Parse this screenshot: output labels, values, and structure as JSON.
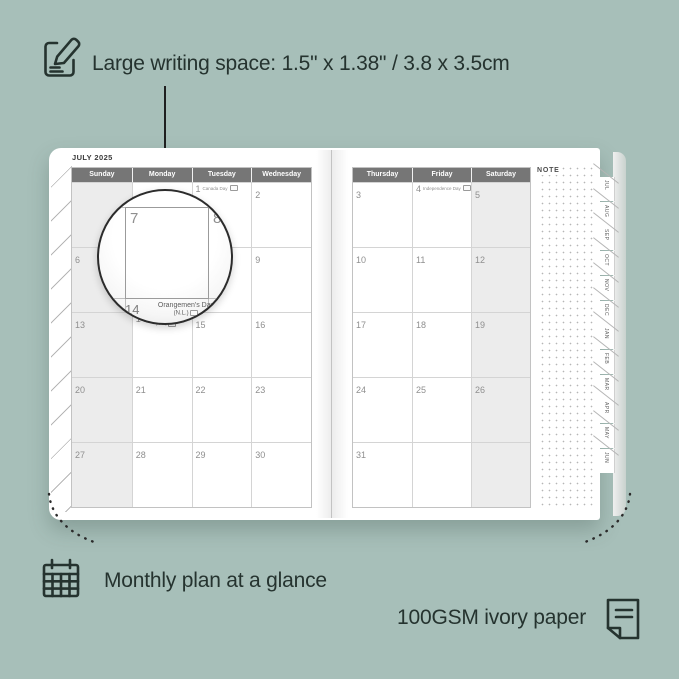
{
  "colors": {
    "background": "#a7bfb9",
    "ink": "#25332f",
    "header_bar": "#767676",
    "shaded_cell": "#ececec",
    "page": "#ffffff"
  },
  "annotations": {
    "top": {
      "icon": "note-pencil-icon",
      "text": "Large writing space: 1.5\" x 1.38\" / 3.8 x 3.5cm"
    },
    "bottom_left": {
      "icon": "calendar-icon",
      "text": "Monthly plan at a glance"
    },
    "bottom_right": {
      "icon": "paper-icon",
      "text": "100GSM ivory paper"
    }
  },
  "planner": {
    "month_title": "JULY 2025",
    "note_label": "NOTE",
    "left_page": {
      "day_headers": [
        "Sunday",
        "Monday",
        "Tuesday",
        "Wednesday"
      ],
      "rows": [
        [
          {
            "d": ""
          },
          {
            "d": ""
          },
          {
            "d": "1",
            "h": "Canada Day"
          },
          {
            "d": "2"
          }
        ],
        [
          {
            "d": "6"
          },
          {
            "d": "7"
          },
          {
            "d": "8"
          },
          {
            "d": "9"
          }
        ],
        [
          {
            "d": "13"
          },
          {
            "d": "14",
            "h": "Orangemen's Day",
            "h2": "(N.L.)"
          },
          {
            "d": "15"
          },
          {
            "d": "16"
          }
        ],
        [
          {
            "d": "20"
          },
          {
            "d": "21"
          },
          {
            "d": "22"
          },
          {
            "d": "23"
          }
        ],
        [
          {
            "d": "27"
          },
          {
            "d": "28"
          },
          {
            "d": "29"
          },
          {
            "d": "30"
          }
        ]
      ]
    },
    "right_page": {
      "day_headers": [
        "Thursday",
        "Friday",
        "Saturday"
      ],
      "rows": [
        [
          {
            "d": "3"
          },
          {
            "d": "4",
            "h": "Independence Day"
          },
          {
            "d": "5"
          }
        ],
        [
          {
            "d": "10"
          },
          {
            "d": "11"
          },
          {
            "d": "12"
          }
        ],
        [
          {
            "d": "17"
          },
          {
            "d": "18"
          },
          {
            "d": "19"
          }
        ],
        [
          {
            "d": "24"
          },
          {
            "d": "25"
          },
          {
            "d": "26"
          }
        ],
        [
          {
            "d": "31"
          },
          {
            "d": ""
          },
          {
            "d": ""
          }
        ]
      ]
    },
    "month_tabs": [
      "JUL",
      "AUG",
      "SEP",
      "OCT",
      "NOV",
      "DEC",
      "JAN",
      "FEB",
      "MAR",
      "APR",
      "MAY",
      "JUN"
    ],
    "magnifier": {
      "day_a": "7",
      "day_b": "8",
      "caption_date": "14",
      "caption_line1": "Orangemen's Day",
      "caption_line2": "(N.L.)"
    }
  }
}
